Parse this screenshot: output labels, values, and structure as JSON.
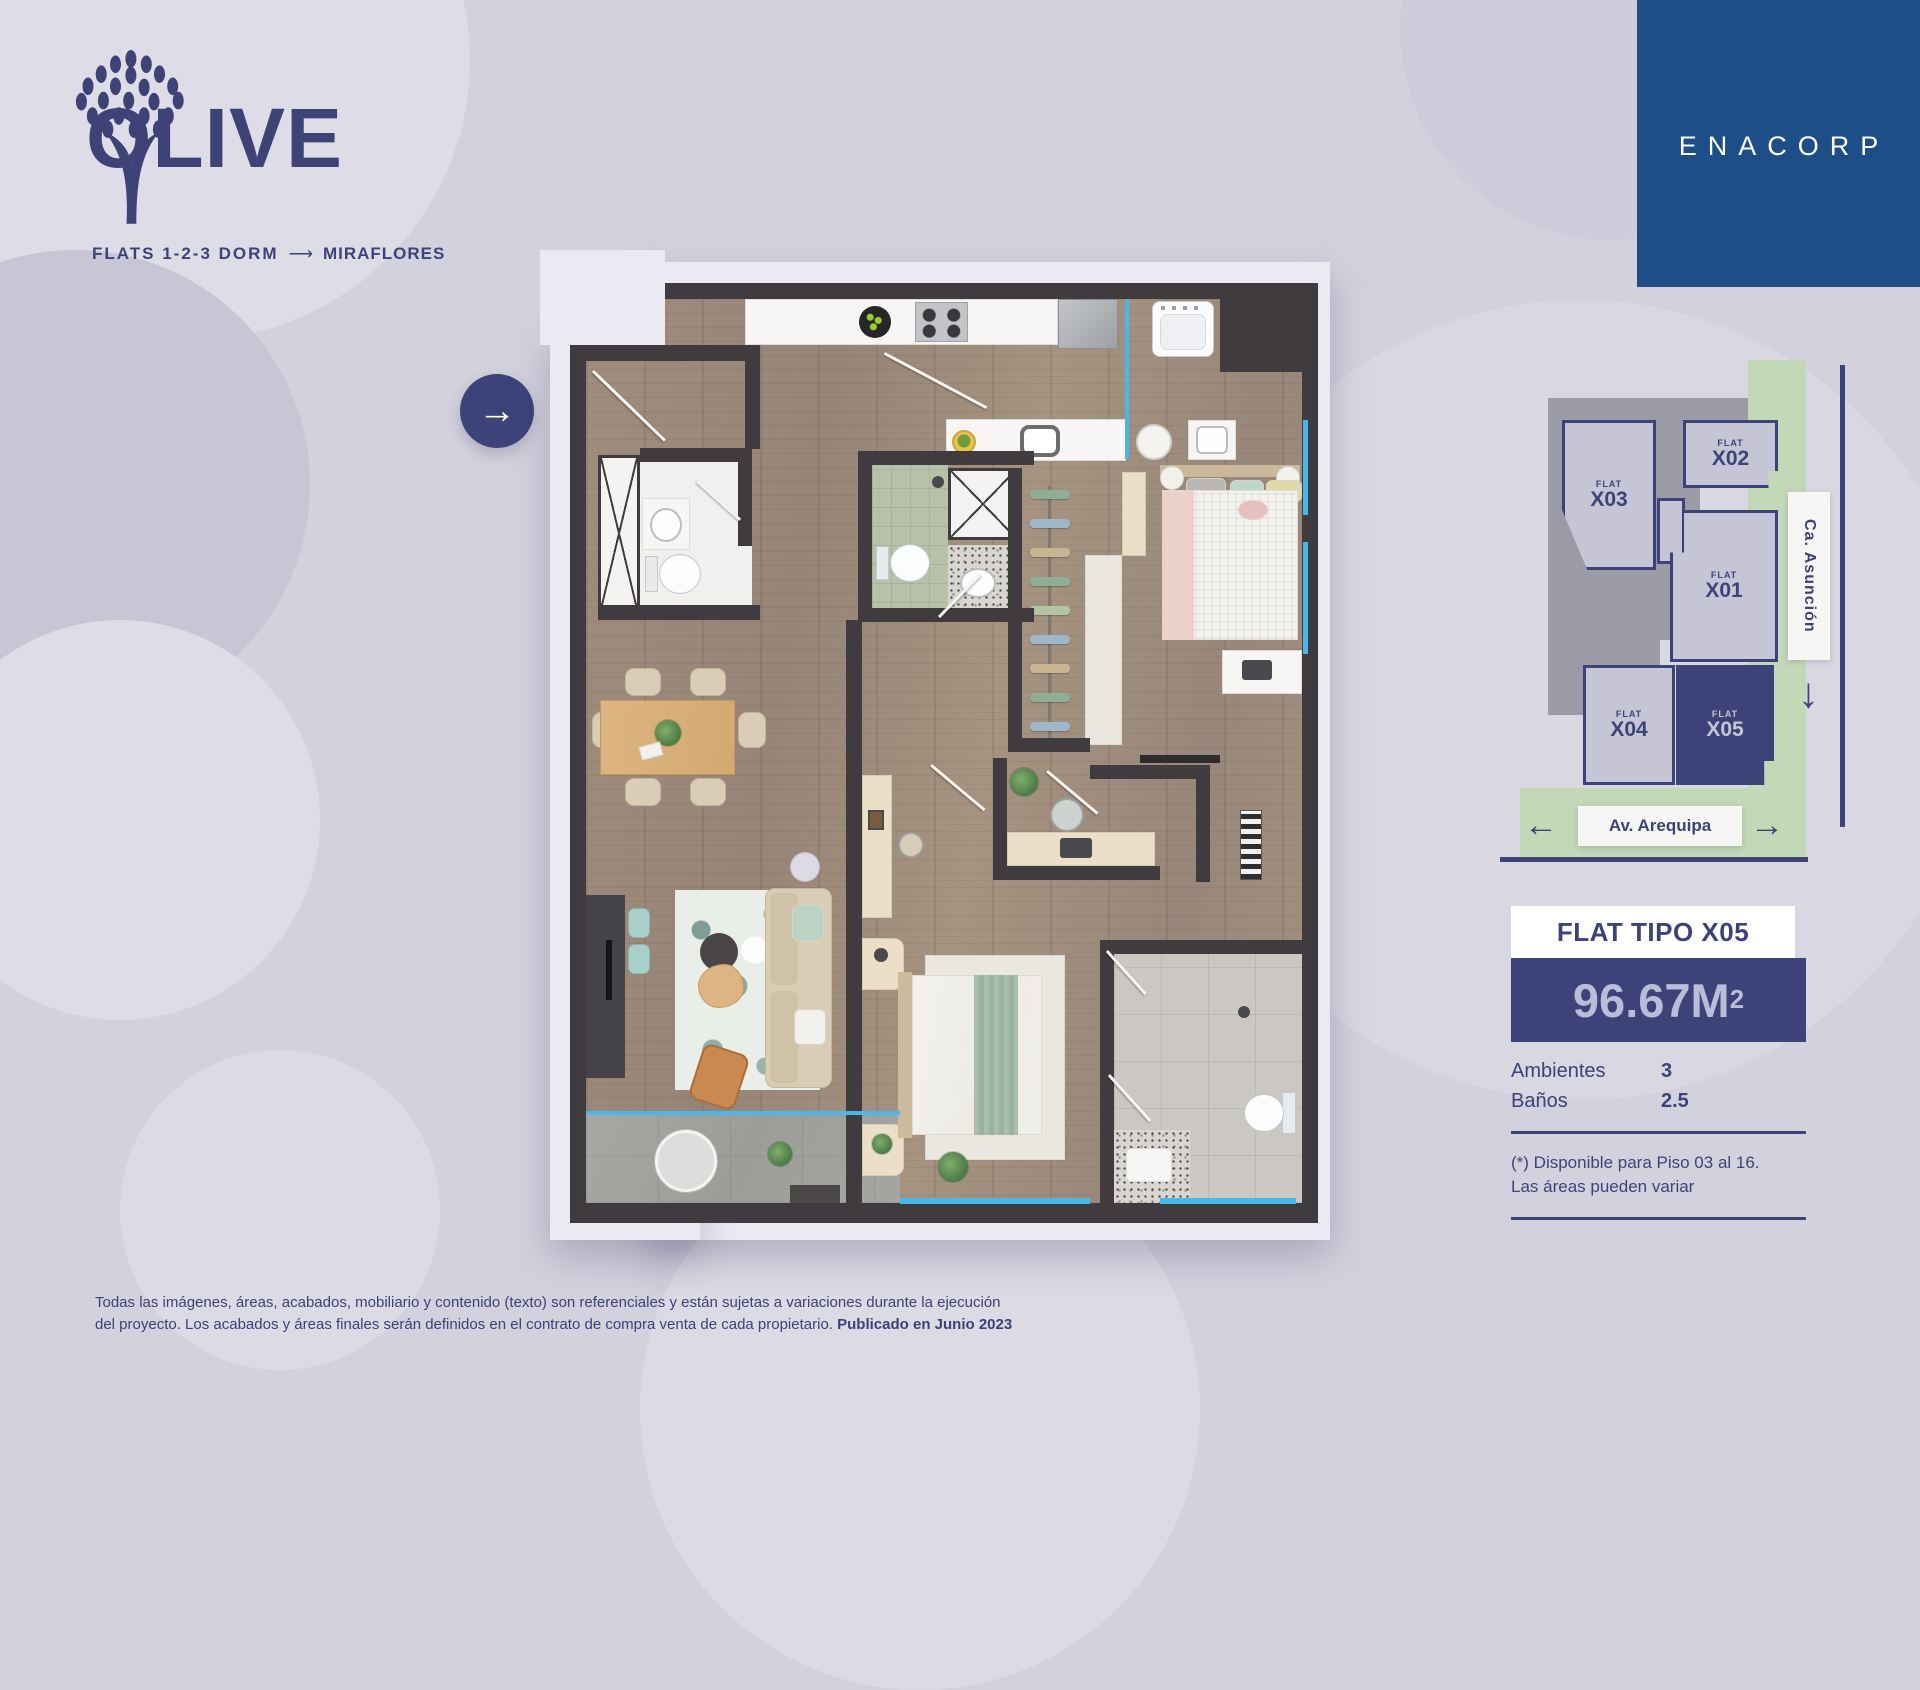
{
  "brand": {
    "name": "OLIVE",
    "tagline_left": "FLATS 1-2-3 DORM",
    "tagline_arrow": "⟶",
    "tagline_right": "MIRAFLORES"
  },
  "developer": {
    "name": "ENACORP"
  },
  "plan": {
    "nav_arrow": "→"
  },
  "sitemap": {
    "streets": {
      "vertical": "Ca. Asunción",
      "horizontal": "Av. Arequipa",
      "arrow_left": "←",
      "arrow_right": "→",
      "arrow_down": "↓"
    },
    "flats": [
      {
        "tag": "FLAT",
        "code": "X03",
        "highlight": false
      },
      {
        "tag": "FLAT",
        "code": "X02",
        "highlight": false
      },
      {
        "tag": "FLAT",
        "code": "X01",
        "highlight": false
      },
      {
        "tag": "FLAT",
        "code": "X04",
        "highlight": false
      },
      {
        "tag": "FLAT",
        "code": "X05",
        "highlight": true
      }
    ]
  },
  "info": {
    "title": "FLAT TIPO X05",
    "area_main": "96.67M",
    "area_sup": "2",
    "rows": [
      {
        "label": "Ambientes",
        "value": "3"
      },
      {
        "label": "Baños",
        "value": "2.5"
      }
    ],
    "note_line1": "(*) Disponible para Piso 03 al 16.",
    "note_line2": "Las áreas pueden variar"
  },
  "disclaimer": {
    "line1": "Todas las imágenes, áreas, acabados, mobiliario y contenido (texto) son referenciales y están sujetas a variaciones durante la ejecución",
    "line2": "del proyecto. Los acabados y áreas finales serán definidos en el contrato de compra venta de cada propietario. ",
    "line2_bold": "Publicado en Junio 2023"
  },
  "colors": {
    "navy": "#3d4378",
    "background": "#d3d1dd",
    "wall": "#3f3b3e",
    "halo": "#ebe9f2",
    "glass": "#49b8e8",
    "site_green": "#c3d8b7",
    "flat_fill": "#c6c5d6",
    "enacorp_blue": "#1d4e87"
  }
}
